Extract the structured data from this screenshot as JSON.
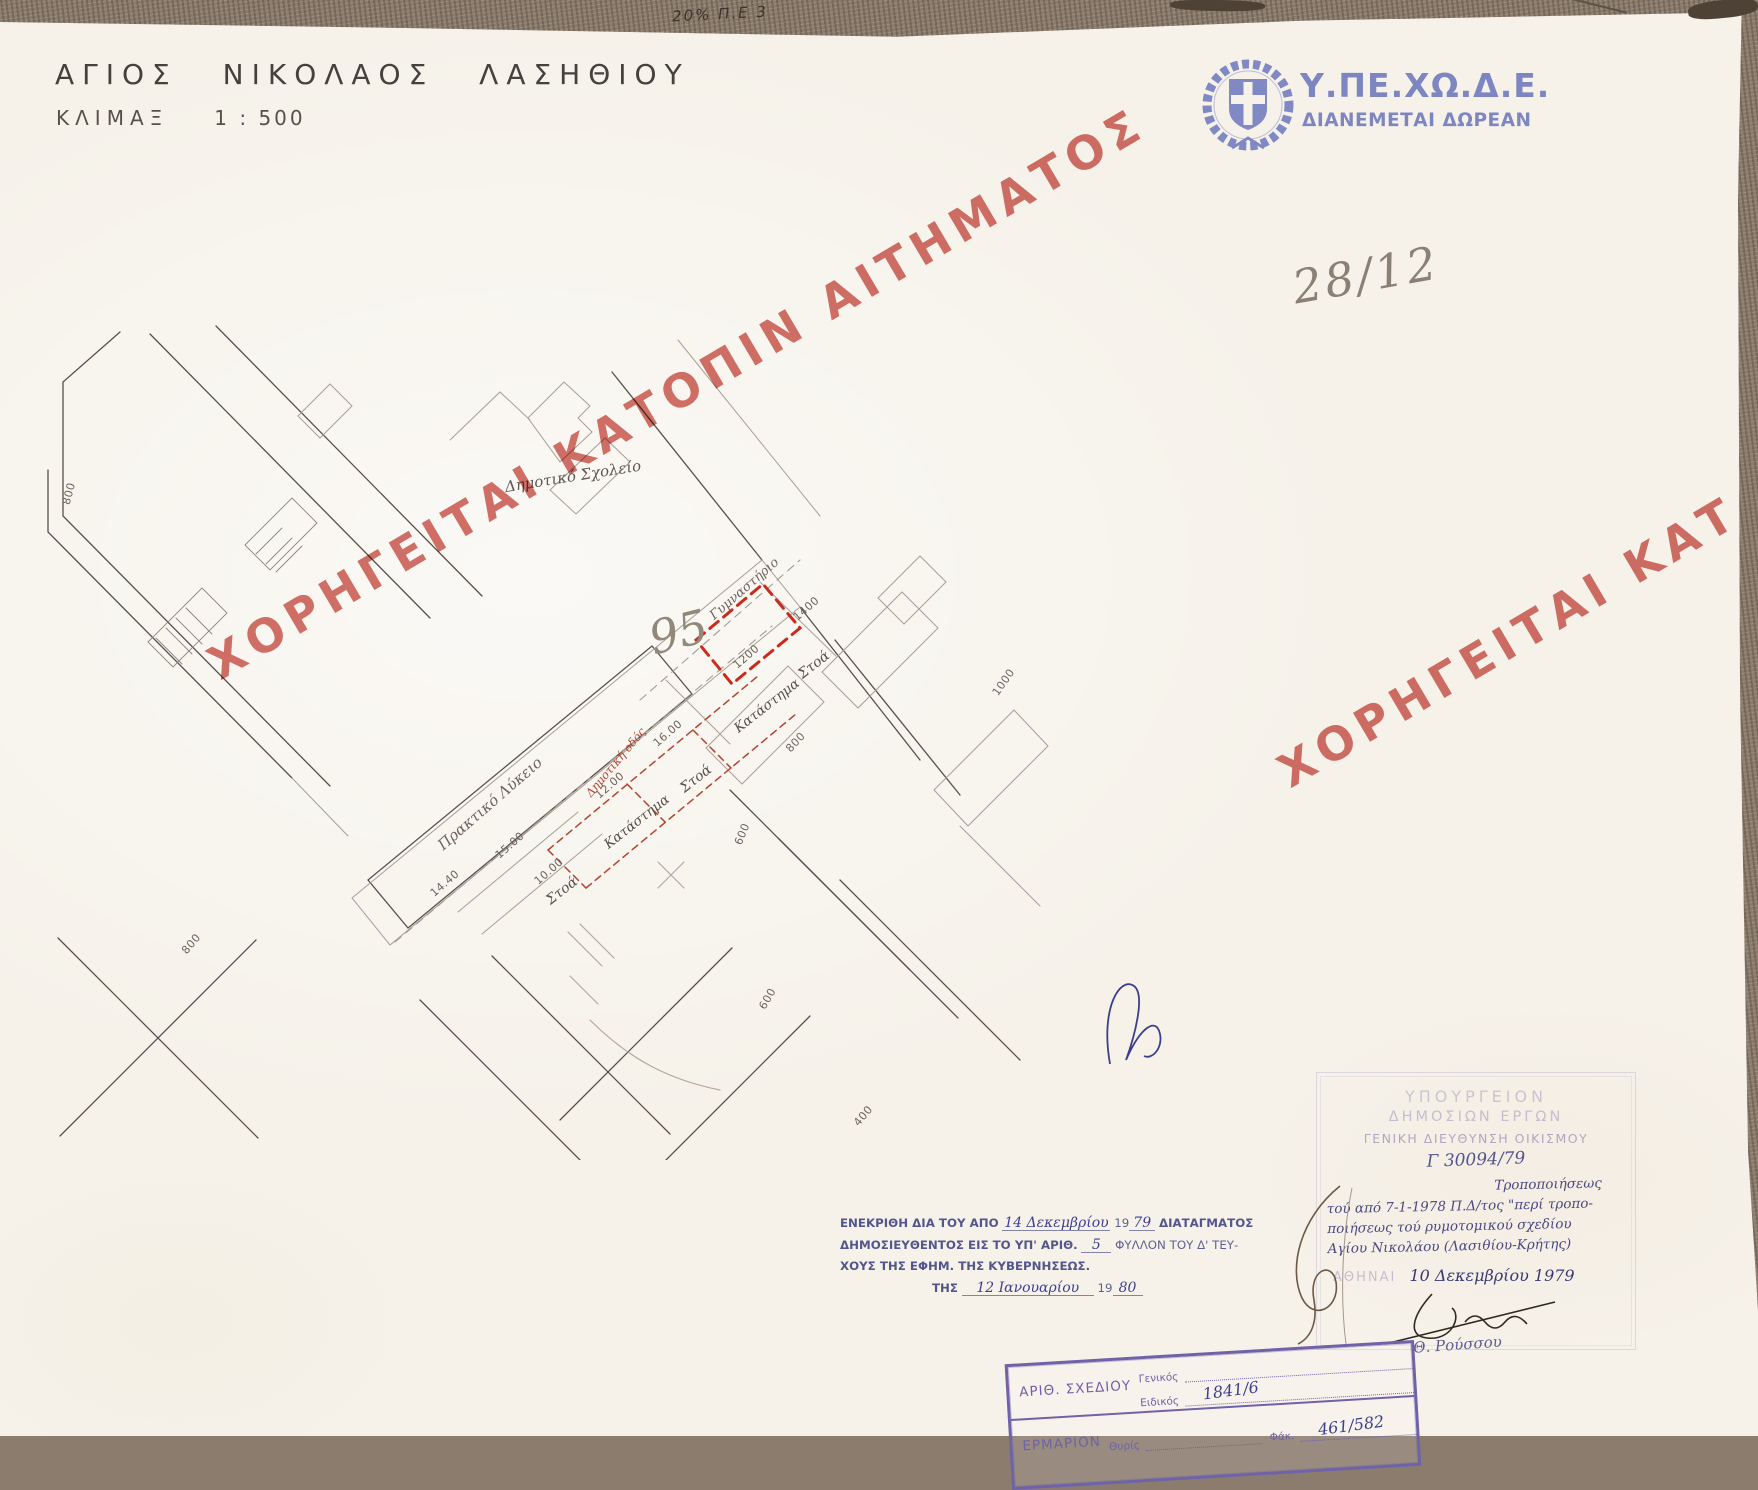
{
  "scan": {
    "top_edge_note": "20% Π.Ε 3",
    "pencil_note": "28/12"
  },
  "header": {
    "title": "ΑΓΙΟΣ ΝΙΚΟΛΑΟΣ ΛΑΣΗΘΙΟΥ",
    "scale_label": "ΚΛΙΜΑΞ",
    "scale_value": "1 : 500"
  },
  "agency": {
    "emblem_icon": "greek-state-wreath-cross-emblem",
    "name": "Υ.ΠΕ.ΧΩ.Δ.Ε.",
    "distribution": "ΔΙΑΝΕΜΕΤΑΙ ΔΩΡΕΑΝ",
    "brand_color": "#7e86c1"
  },
  "watermarks": {
    "main": "ΧΟΡΗΓΕΙΤΑΙ ΚΑΤΟΠΙΝ ΑΙΤΗΜΑΤΟΣ",
    "partial": "ΧΟΡΗΓΕΙΤΑΙ ΚΑΤ",
    "color": "#d0625c"
  },
  "map": {
    "parcel_number": "95",
    "labels": {
      "school": "Δημοτικό Σχολείο",
      "gym": "Γυμναστήριο",
      "lyceum": "Πρακτικό Λύκειο",
      "arcade1": "Στοά",
      "shop1": "Κατάστημα",
      "arcade2": "Στοά",
      "shop2": "Κατάστημα",
      "arcade3": "Στοά",
      "road_note": "Δημοτική οδός"
    },
    "dims": {
      "w800a": "800",
      "w800b": "800",
      "d1440": "14.40",
      "d1500": "15.00",
      "d1000": "10.00",
      "d1200a": "12.00",
      "d1600": "16.00",
      "d1200b": "1200",
      "d1400": "1400",
      "w1000": "1000",
      "w800r": "800",
      "w600a": "600",
      "w600b": "600",
      "w400": "400"
    }
  },
  "approval": {
    "l1a": "ΕΝΕΚΡΙΘΗ ΔΙΑ ΤΟΥ ΑΠΟ",
    "l1_ink": "14 Δεκεμβρίου",
    "l1b": "19",
    "l1_ink2": "79",
    "l1c": "ΔΙΑΤΑΓΜΑΤΟΣ",
    "l2a": "ΔΗΜΟΣΙΕΥΘΕΝΤΟΣ ΕΙΣ ΤΟ ΥΠ' ΑΡΙΘ.",
    "l2_ink": "5",
    "l2b": "ΦΥΛΛΟΝ ΤΟΥ Δ' ΤΕΥ-",
    "l3": "ΧΟΥΣ ΤΗΣ ΕΦΗΜ. ΤΗΣ ΚΥΒΕΡΝΗΣΕΩΣ.",
    "l4a": "ΤΗΣ",
    "l4_ink": "12 Ιανουαρίου",
    "l4b": "19",
    "l4_ink2": "80"
  },
  "ministry_stamp": {
    "ministry": "ΥΠΟΥΡΓΕΙΟΝ",
    "department": "ΔΗΜΟΣΙΩΝ ΕΡΓΩΝ",
    "directorate": "ΓΕΝΙΚΗ ΔΙΕΥΘΥΝΣΗ ΟΙΚΙΣΜΟΥ",
    "protocol": "Γ 30094/79",
    "subject1": "Τροποποιήσεως",
    "subject2": "τού από 7-1-1978 Π.Δ/τος \"περί τροπο-",
    "subject3": "ποιήσεως τού ρυμοτομικού σχεδίου",
    "subject4": "Αγίου Νικολάου (Λασιθίου-Κρήτης)",
    "place": "ΑΘΗΝΑΙ",
    "date": "10 Δεκεμβρίου 1979",
    "signer": "Θ. Ρούσσου"
  },
  "filing_stamp": {
    "row1_label": "ΑΡΙΘ. ΣΧΕΔΙΟΥ",
    "general_label": "Γενικός",
    "special_label": "Ειδικός",
    "special_value": "1841/6",
    "row2_label": "ΕΡΜΑΡΙΟΝ",
    "slot_label": "Θυρίς",
    "folder_label": "Φάκ.",
    "folder_value": "461/582"
  }
}
